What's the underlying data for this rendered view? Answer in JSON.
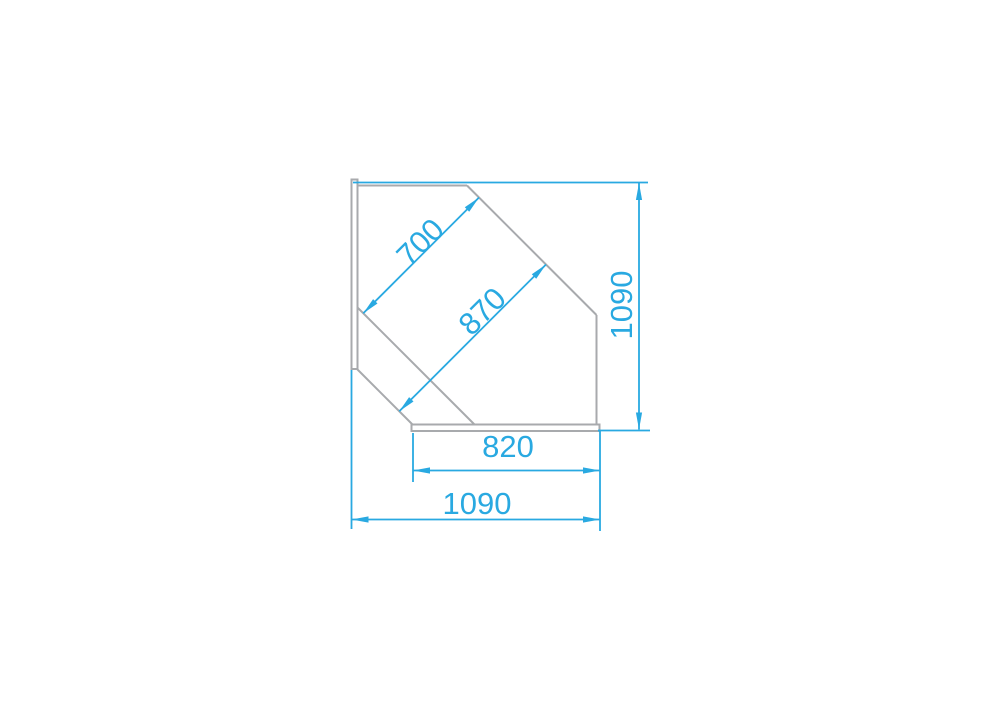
{
  "colors": {
    "dimension_blue": "#29a9e1",
    "outline_gray": "#a8aaad",
    "background": "#ffffff"
  },
  "dimensions": {
    "upper_diagonal": "700",
    "lower_diagonal": "870",
    "right_height": "1090",
    "base_width": "820",
    "overall_width": "1090"
  }
}
